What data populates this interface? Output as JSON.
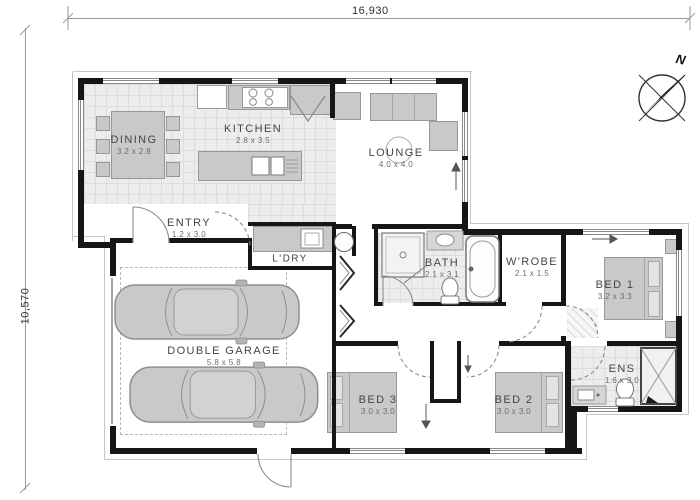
{
  "plan": {
    "top_dimension": "16,930",
    "left_dimension": "10,570",
    "compass_north": "N"
  },
  "rooms": {
    "dining": {
      "name": "DINING",
      "size": "3.2 x 2.8"
    },
    "kitchen": {
      "name": "KITCHEN",
      "size": "2.8 x 3.5"
    },
    "lounge": {
      "name": "LOUNGE",
      "size": "4.0 x 4.0"
    },
    "entry": {
      "name": "ENTRY",
      "size": "1.2 x 3.0"
    },
    "laundry": {
      "name": "L'DRY"
    },
    "garage": {
      "name": "DOUBLE GARAGE",
      "size": "5.8 x 5.8"
    },
    "bath": {
      "name": "BATH",
      "size": "2.1 x 3.1"
    },
    "wardrobe": {
      "name": "W'ROBE",
      "size": "2.1 x 1.5"
    },
    "bed1": {
      "name": "BED 1",
      "size": "3.2 x 3.3"
    },
    "bed2": {
      "name": "BED 2",
      "size": "3.0 x 3.0"
    },
    "bed3": {
      "name": "BED 3",
      "size": "3.0 x 3.0"
    },
    "ensuite": {
      "name": "ENS",
      "size": "1.6 x 3.0"
    }
  },
  "colors": {
    "wall": "#161616",
    "tile_floor": "#ededed",
    "furniture": "#c9c9c9"
  }
}
